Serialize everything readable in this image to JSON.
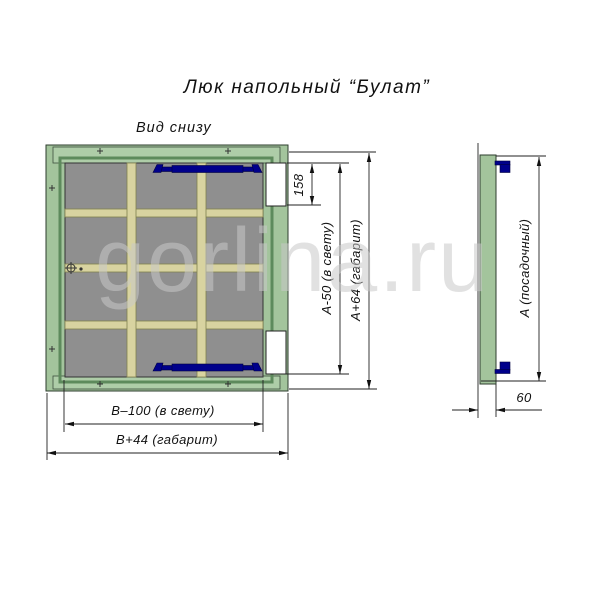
{
  "title": "Люк напольный “Булат”",
  "view_label": "Вид снизу",
  "watermark": "gorlina.ru",
  "dimensions": {
    "slot_height": "158",
    "inner_height": "A-50 (в свету)",
    "outer_height": "A+64 (габарит)",
    "inner_width": "B–100 (в свету)",
    "outer_width": "B+44 (габарит)",
    "seat_height": "A (посадочный)",
    "thickness": "60"
  },
  "colors": {
    "frame_green": "#a3c49c",
    "frame_green_light": "#aecda8",
    "frame_dark": "#5d8a5c",
    "panel_gray": "#8f8f8f",
    "bar_tan": "#d8d3a0",
    "hinge_blue": "#00008b",
    "line": "#1a1a1a",
    "watermark_gray": "#c9c9c9"
  }
}
